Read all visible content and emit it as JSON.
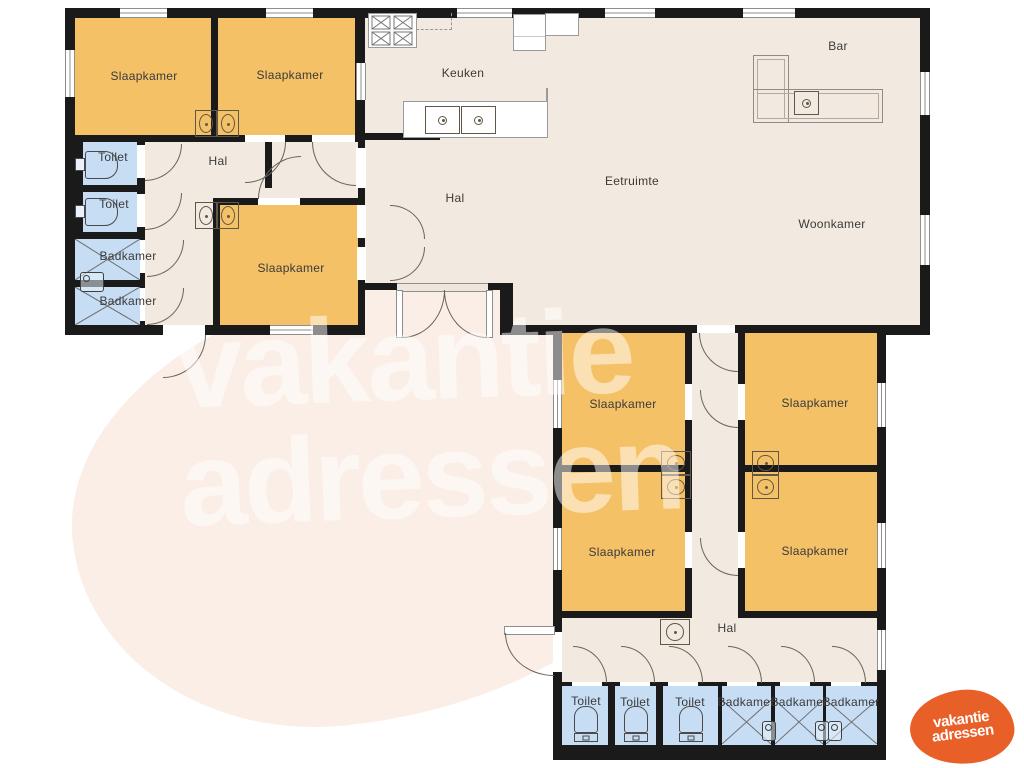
{
  "rooms": {
    "slaapkamer_nw": "Slaapkamer",
    "slaapkamer_ne": "Slaapkamer",
    "slaapkamer_w": "Slaapkamer",
    "toilet_w1": "Toilet",
    "toilet_w2": "Toilet",
    "badkamer_w1": "Badkamer",
    "badkamer_w2": "Badkamer",
    "hal_w": "Hal",
    "hal_mid": "Hal",
    "keuken": "Keuken",
    "eetruimte": "Eetruimte",
    "woonkamer": "Woonkamer",
    "bar": "Bar",
    "slaapkamer_s1": "Slaapkamer",
    "slaapkamer_s2": "Slaapkamer",
    "slaapkamer_s3": "Slaapkamer",
    "slaapkamer_s4": "Slaapkamer",
    "hal_s": "Hal",
    "toilet_s1": "Toilet",
    "toilet_s2": "Toilet",
    "toilet_s3": "Toilet",
    "badkamer_s1": "Badkamer",
    "badkamer_s2": "Badkamer",
    "badkamer_s3": "Badkamer"
  },
  "watermark": {
    "line1": "vakantie",
    "line2": "adressen"
  },
  "logo": {
    "line1": "vakantie",
    "line2": "adressen"
  },
  "colors": {
    "wall": "#1a1a1a",
    "floor": "#f2eae0",
    "bedroom": "#f5c167",
    "wetroom": "#c6ddf4",
    "logo_orange": "#e85f28",
    "watermark_pink": "#fbeee7"
  }
}
